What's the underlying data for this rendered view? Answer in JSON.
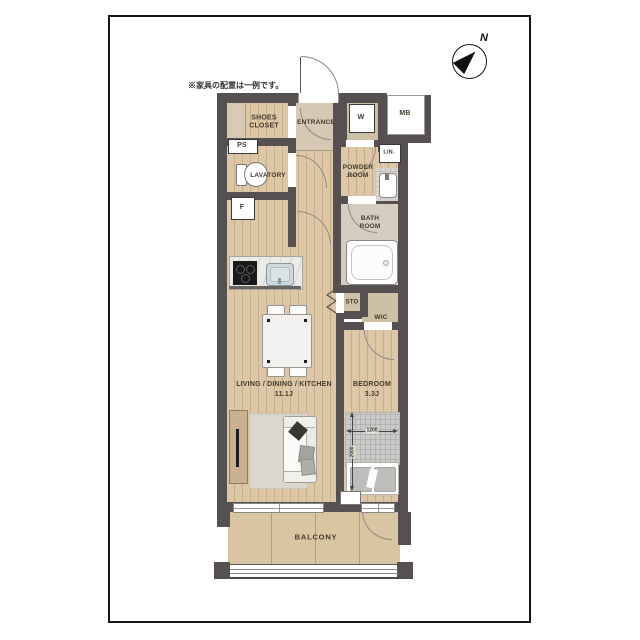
{
  "note": "※家具の配置は一例です。",
  "compass": {
    "north_label": "N"
  },
  "rooms": {
    "shoes_closet": "SHOES CLOSET",
    "entrance": "ENTRANCE",
    "washer": "W",
    "meter_box": "MB",
    "pipe_shaft": "PS",
    "linen": "LIN.",
    "lavatory": "LAVATORY",
    "powder_room": "POWDER ROOM",
    "refrigerator": "F",
    "bath_room": "BATH ROOM",
    "storage": "STO",
    "walk_in_closet": "WIC",
    "ldk": "LIVING / DINING / KITCHEN",
    "ldk_size": "11.1J",
    "bedroom": "BEDROOM",
    "bedroom_size": "3.3J",
    "balcony": "BALCONY"
  },
  "bed_dimensions": {
    "width_mm": "1200",
    "depth_mm": "2000"
  },
  "colors": {
    "wall": "#575051",
    "wood_floor": "#ddc7a6",
    "closet_floor": "#cec0a4",
    "balcony_floor": "#d9c5a1",
    "bath_floor": "#d6cdc0",
    "frame": "#151515"
  }
}
